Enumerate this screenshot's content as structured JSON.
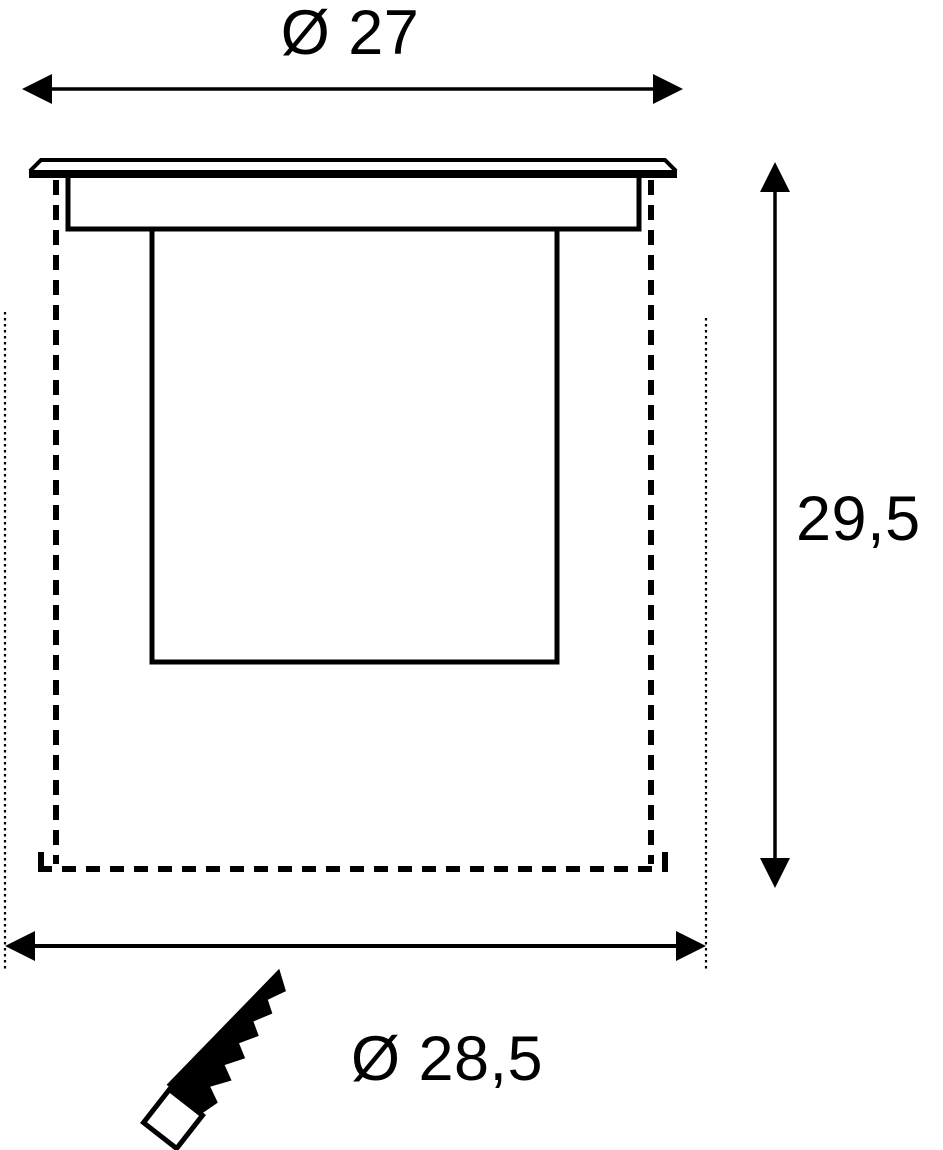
{
  "drawing": {
    "labels": {
      "top_diameter": "Ø 27",
      "height": "29,5",
      "bottom_diameter": "Ø 28,5"
    },
    "colors": {
      "line": "#000000",
      "background": "#ffffff",
      "text": "#000000"
    }
  }
}
